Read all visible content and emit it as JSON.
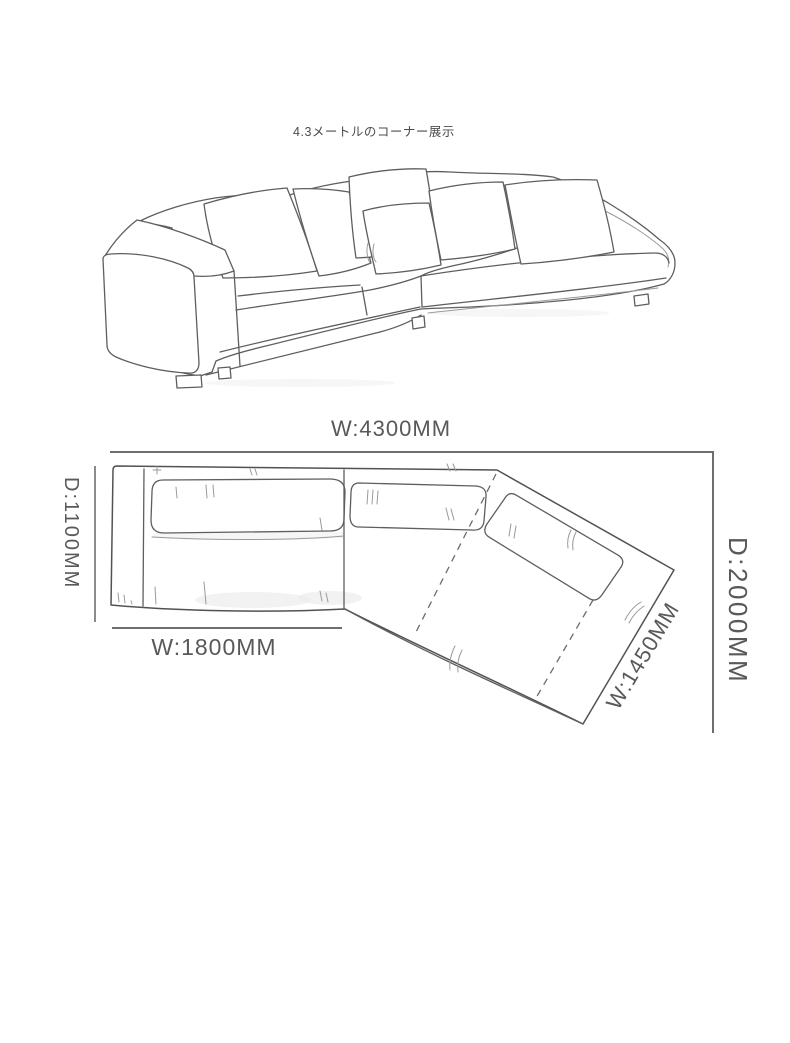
{
  "header": {
    "title": "4.3メートルのコーナー展示"
  },
  "plan": {
    "labels": {
      "total_width": "W:4300MM",
      "left_depth": "D:1100MM",
      "left_section_width": "W:1800MM",
      "right_depth": "D:2000MM",
      "chaise_width": "W:1450MM"
    }
  },
  "colors": {
    "background": "#ffffff",
    "line_art": "#5e5e5e",
    "dimension_lines": "#6e6e6e",
    "label_text": "#59595b",
    "title_text": "#4c4c4c"
  }
}
